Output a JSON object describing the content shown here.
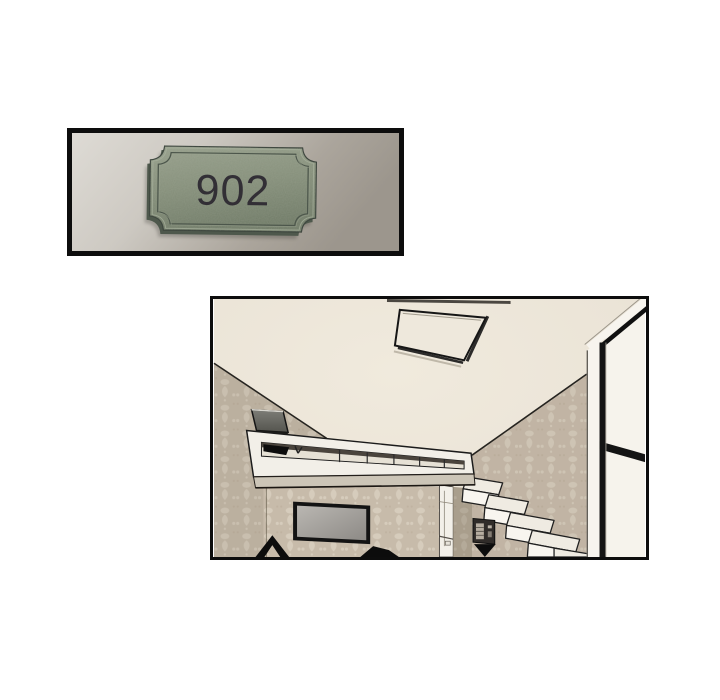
{
  "comic": {
    "page_background": "#ffffff",
    "panel_count": 2,
    "panels": [
      {
        "id": "door-sign-photo",
        "kind": "photograph",
        "border_color": "#0d0d0d",
        "wall_color_light": "#dcd9d3",
        "wall_color_dark": "#a09a91",
        "sign": {
          "number": "902",
          "shape": "notched-corner-plaque",
          "plate_color": "#86907b",
          "plate_edge_color": "#4e584c",
          "inner_line_color": "#4c564b",
          "text_color": "#2e2a32"
        }
      },
      {
        "id": "apartment-interior-illustration",
        "kind": "line-art-illustration",
        "border_color": "#0d0d0d",
        "ceiling_color": "#ece6da",
        "wallpaper_color": "#c7bbaa",
        "wallpaper_motif_color": "#d6ccbc",
        "line_color": "#1b1b1b",
        "loft_color": "#f2efe8",
        "stair_color": "#f5f2ea",
        "objects": [
          "ceiling-light",
          "loft-ledge-with-railing",
          "laptop-on-loft",
          "damask-left-wall",
          "damask-right-wall",
          "tv-on-wall",
          "kitchen-nook",
          "box-staircase",
          "wall-appliance",
          "glass-partition-frame",
          "furniture-silhouettes"
        ]
      }
    ]
  }
}
